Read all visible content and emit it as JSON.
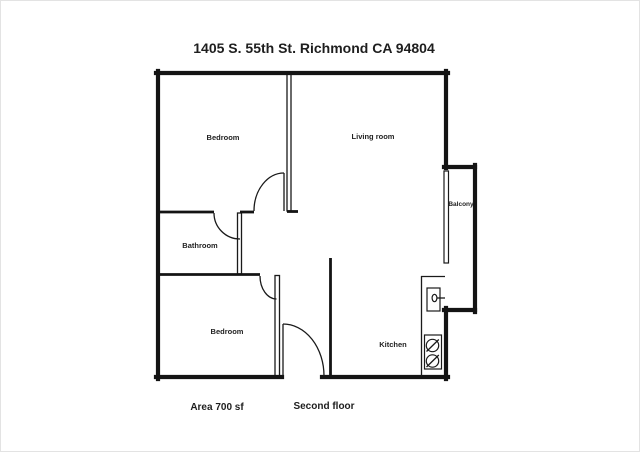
{
  "title": "1405 S. 55th St. Richmond CA 94804",
  "rooms": {
    "bedroom_top": "Bedroom",
    "living_room": "Living room",
    "bathroom": "Bathroom",
    "bedroom_bottom": "Bedroom",
    "kitchen": "Kitchen",
    "balcony": "Balcony"
  },
  "footer": {
    "area": "Area 700 sf",
    "floor": "Second floor"
  },
  "colors": {
    "wall": "#141414",
    "text": "#1e1e1e",
    "background": "#ffffff"
  }
}
